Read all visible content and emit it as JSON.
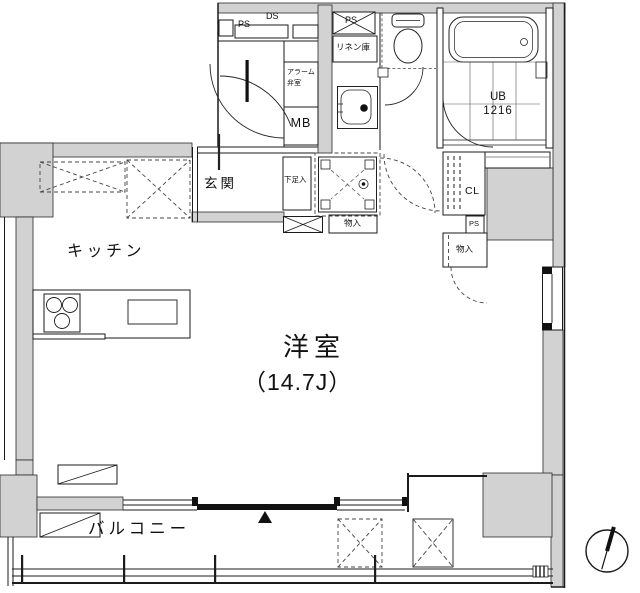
{
  "meta": {
    "type": "apartment-floor-plan"
  },
  "colors": {
    "wall_fill": "#d2d2d2",
    "line_color": "#1b1b1b"
  },
  "labels": {
    "ds": "DS",
    "ps_duct": "PS",
    "ps_shaft": "PS",
    "linen": "リネン庫",
    "alarm_line1": "アラーム",
    "alarm_line2": "弁室",
    "meter_box": "MB",
    "bath_name": "UB",
    "bath_size": "1216",
    "entrance": "玄関",
    "shoe_box": "下足入",
    "kitchen": "キッチン",
    "closet": "CL",
    "ps_closet": "PS",
    "storage_hall": "物入",
    "storage_closet": "物入",
    "main_room": "洋室",
    "main_room_size": "（14.7J）",
    "balcony": "バルコニー"
  }
}
